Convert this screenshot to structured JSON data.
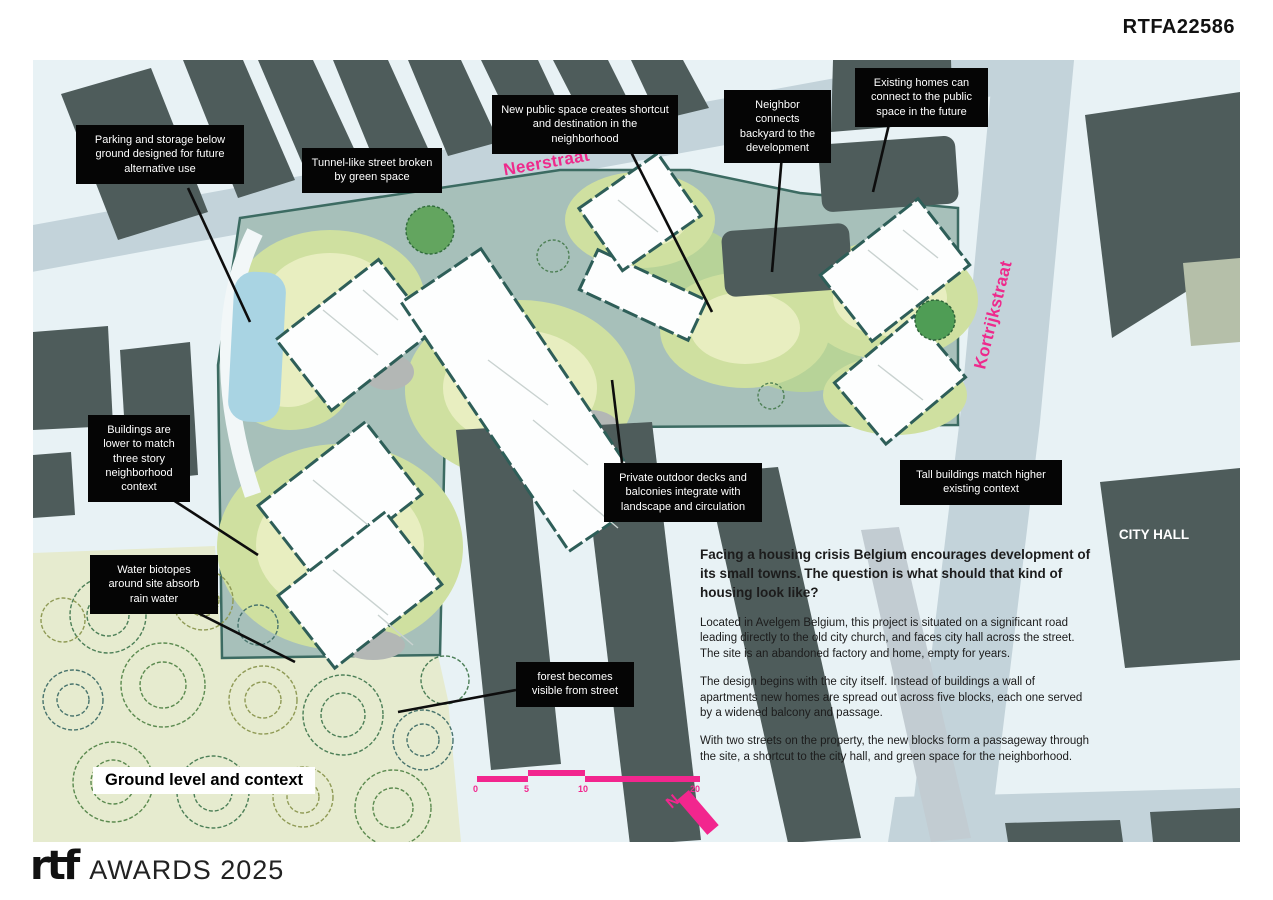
{
  "header": {
    "code": "RTFA22586"
  },
  "footer": {
    "logo": "rtf",
    "brand": "AWARDS 2025"
  },
  "map": {
    "streets": {
      "neerstraat": "Neerstraat",
      "kortrijkstraat": "Kortrijkstraat"
    },
    "city_hall": "CITY HALL",
    "title": "Ground level and context",
    "north_label": "N",
    "scale": {
      "labels": [
        "0",
        "5",
        "10",
        "20"
      ]
    },
    "colors": {
      "accent_pink": "#f2268e",
      "existing_building": "#4e5c5b",
      "site_hardscape": "#a7c0ba",
      "landscape_green": "#cfe0a0",
      "landscape_light": "#e8eec0",
      "water": "#a9d4e3",
      "road": "#c3d3da",
      "background": "#e8f2f5",
      "callout_bg": "#050505",
      "new_building_wall": "#2e5e58"
    }
  },
  "callouts": {
    "parking": "Parking and storage below ground designed for future alternative use",
    "tunnel": "Tunnel-like street broken by green space",
    "new_public": "New public space creates shortcut and destination in the neighborhood",
    "neighbor": "Neighbor connects backyard to the development",
    "existing_homes": "Existing homes can connect to the public space in the future",
    "lower_buildings": "Buildings are lower to match three story neighborhood context",
    "water_biotopes": "Water biotopes around site absorb rain water",
    "decks": "Private outdoor decks and balconies integrate with landscape and circulation",
    "tall_buildings": "Tall buildings match higher existing context",
    "forest": "forest becomes visible from street"
  },
  "description": {
    "heading": "Facing a housing crisis Belgium encourages development of its small towns. The question is what should that kind of housing look like?",
    "paragraphs": [
      "Located in Avelgem Belgium, this project is situated on a significant road leading directly to the old city church, and faces city hall across the street. The site is an abandoned factory and home, empty for years.",
      "The design begins with the city itself. Instead of buildings a wall of apartments new homes are spread out across five blocks, each one served by a widened balcony and passage.",
      "With two streets on the property, the new blocks form a passageway through the site, a shortcut to the city hall, and green space for the neighborhood."
    ]
  }
}
